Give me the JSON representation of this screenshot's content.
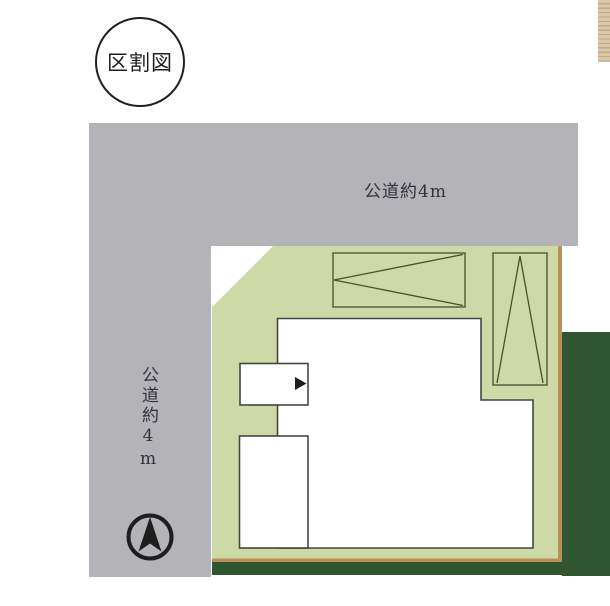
{
  "title_badge": {
    "label": "区割図"
  },
  "roads": {
    "top": {
      "label": "公道約4m"
    },
    "left": {
      "label": "公道約4m"
    }
  },
  "colors": {
    "road_gray": "#b3b3b8",
    "lot_green": "#cdd9a6",
    "parking_line": "#47512d",
    "building_fill": "#ffffff",
    "building_line": "#454543",
    "greenery_dark": "#2f5531",
    "boundary_tan": "#b98f58",
    "deck_light": "#dbc7aa",
    "deck_dark": "#c3a98a",
    "label_text": "#32323c",
    "ink_black": "#1e1e1e"
  }
}
